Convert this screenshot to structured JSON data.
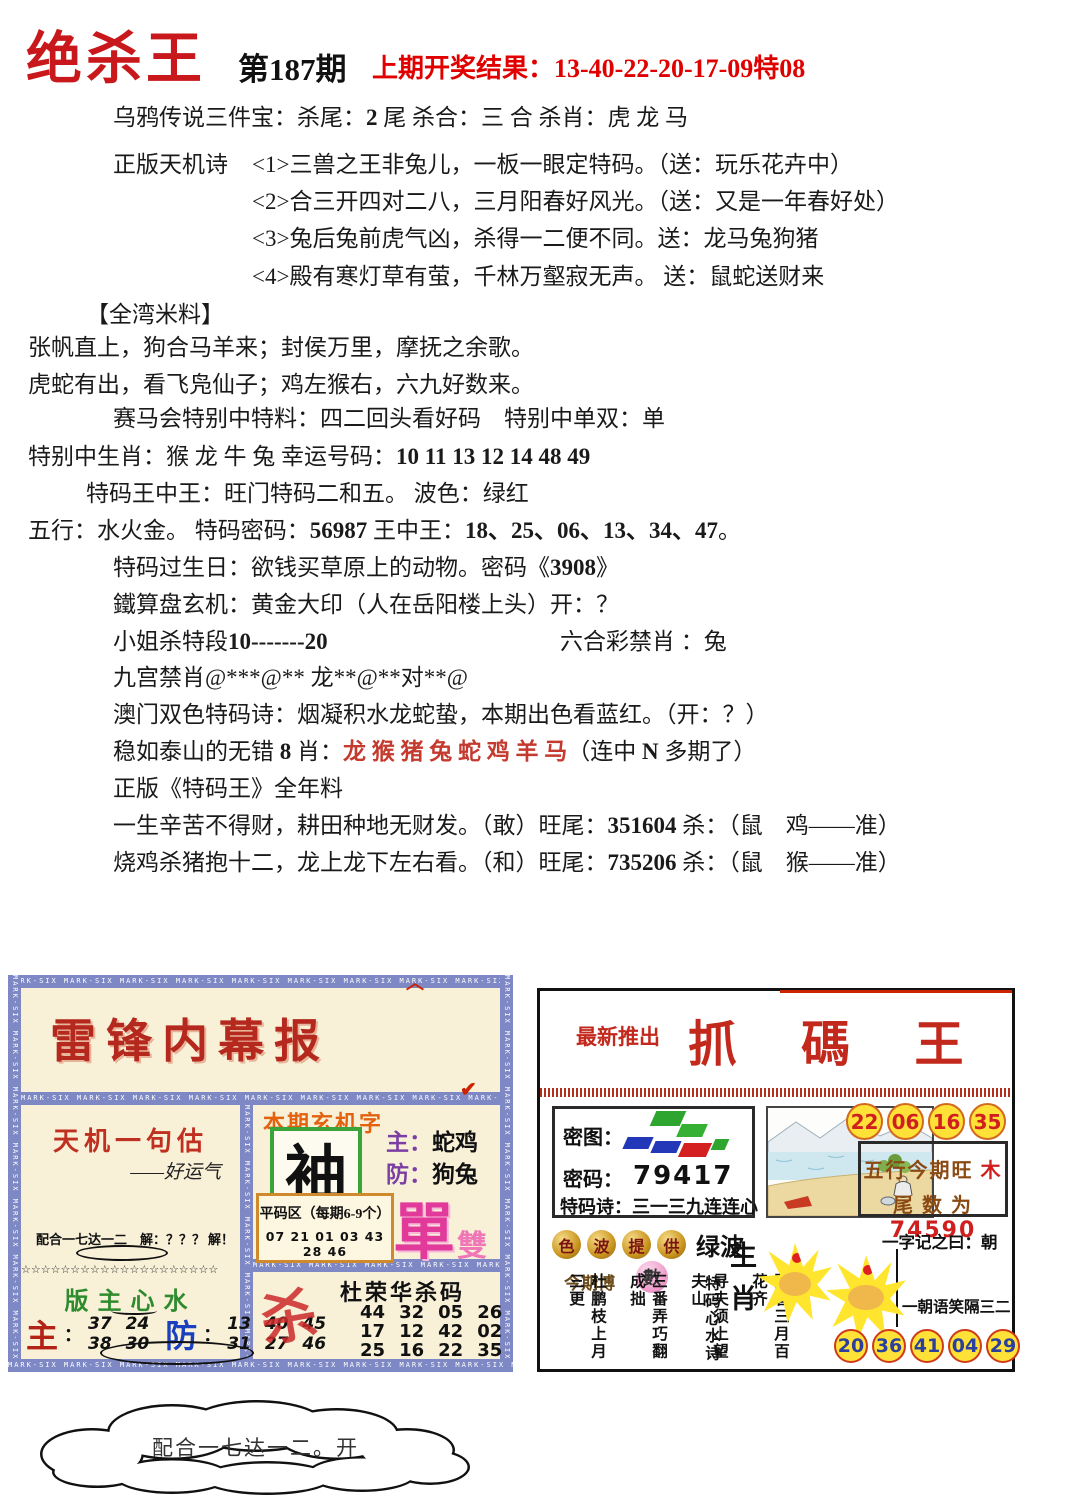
{
  "header": {
    "title": "绝杀王",
    "issue": "第187期",
    "result": "上期开奖结果：13-40-22-20-17-09特08"
  },
  "main": {
    "lines": [
      [
        {
          "t": "乌鸦传说三件宝：杀尾："
        },
        {
          "t": "2",
          "c": "b"
        },
        {
          "t": " 尾 杀合：三 合 杀肖：虎 龙 马"
        }
      ],
      [
        {
          "t": "正版天机诗"
        }
      ],
      [
        {
          "t": "<1>三兽之王非兔儿，一板一眼定特码。（送：玩乐花卉中）"
        }
      ],
      [
        {
          "t": "<2>合三开四对二八，三月阳春好风光。（送：又是一年春好处）"
        }
      ],
      [
        {
          "t": "<3>兔后兔前虎气凶，杀得一二便不同。送：龙马兔狗猪"
        }
      ],
      [
        {
          "t": "<4>殿有寒灯草有萤，千林万壑寂无声。 送：鼠蛇送财来"
        }
      ],
      [
        {
          "t": "【全湾米料】"
        }
      ],
      [
        {
          "t": "张帆直上，狗合马羊来；封侯万里，摩抚之余歌。"
        }
      ],
      [
        {
          "t": "虎蛇有出，看飞凫仙子；鸡左猴右，六九好数来。"
        }
      ],
      [
        {
          "t": "赛马会特别中特料：四二回头看好码　特别中单双：单"
        }
      ],
      [
        {
          "t": "特别中生肖：猴 龙 牛 兔 幸运号码："
        },
        {
          "t": "10 11 13 12 14 48 49",
          "c": "b"
        }
      ],
      [
        {
          "t": "特码王中王：旺门特码二和五。 波色：绿红"
        }
      ],
      [
        {
          "t": "五行：水火金。 特码密码："
        },
        {
          "t": "56987",
          "c": "b"
        },
        {
          "t": " 王中王："
        },
        {
          "t": "18、25、06、13、34、47",
          "c": "b"
        },
        {
          "t": "。"
        }
      ],
      [
        {
          "t": "特码过生日：欲钱买草原上的动物。密码《"
        },
        {
          "t": "3908",
          "c": "b"
        },
        {
          "t": "》"
        }
      ],
      [
        {
          "t": "鐵算盘玄机：黄金大印（人在岳阳楼上头）开：？"
        }
      ],
      [
        {
          "t": "小姐杀特段"
        },
        {
          "t": "10-------20",
          "c": "b"
        }
      ],
      [
        {
          "t": "六合彩禁肖 ：兔"
        }
      ],
      [
        {
          "t": "九宫禁肖@***@** 龙**@**对**@"
        }
      ],
      [
        {
          "t": "澳门双色特码诗：烟凝积水龙蛇蛰，本期出色看蓝红。（开：？）"
        }
      ],
      [
        {
          "t": "稳如泰山的无错 "
        },
        {
          "t": "8",
          "c": "b"
        },
        {
          "t": " 肖："
        },
        {
          "t": "龙 猴 猪 兔 蛇 鸡 羊 马",
          "c": "r"
        },
        {
          "t": "（连中 "
        },
        {
          "t": "N",
          "c": "b"
        },
        {
          "t": " 多期了）"
        }
      ],
      [
        {
          "t": "正版《特码王》全年料"
        }
      ],
      [
        {
          "t": "一生辛苦不得财，耕田种地无财发。（敢）旺尾："
        },
        {
          "t": "351604",
          "c": "b"
        },
        {
          "t": " 杀：（鼠　鸡——准）"
        }
      ],
      [
        {
          "t": "烧鸡杀猪抱十二，龙上龙下左右看。（和）旺尾："
        },
        {
          "t": "735206",
          "c": "b"
        },
        {
          "t": " 杀：（鼠　猴——准）"
        }
      ]
    ]
  },
  "left_panel": {
    "border_text": "MARK-SIX ",
    "title": "雷锋内幕报",
    "caret_icon": "︿",
    "check_icon": "✔",
    "stars_char": "☆",
    "box_tianji": {
      "title": "天机一句估",
      "signature": "——好运气",
      "footer_left": "配合一七达一二　解：？？？",
      "footer_right": "解！"
    },
    "box_banzhu": {
      "title": "版主心水",
      "zhu_label": "主",
      "fang_label": "防",
      "colon": "：",
      "zhu_rows": [
        "37 24",
        "38 30"
      ],
      "fang_rows": [
        "13 40 45",
        "31 27 46"
      ]
    },
    "box_xuanji": {
      "title": "本期玄机字",
      "char": "袖",
      "zhu_label": "主：",
      "zhu_value": "蛇鸡",
      "fang_label": "防：",
      "fang_value": "狗兔",
      "pingma_title": "平码区（每期6-9个）",
      "pingma_numbers": "07 21 01 03 43 28 46",
      "dan": "單",
      "shuang": "雙"
    },
    "box_sha": {
      "glyph": "杀",
      "title": "杜荣华杀码",
      "rows": [
        [
          "44",
          "32",
          "05",
          "26"
        ],
        [
          "17",
          "12",
          "42",
          "02"
        ],
        [
          "25",
          "16",
          "22",
          "35"
        ]
      ]
    }
  },
  "right_panel": {
    "promo": "最新推出",
    "title": "抓 碼 王",
    "mitu_label": "密图：",
    "mima_label": "密码：",
    "mima_value": "79417",
    "shici_label": "特码诗：",
    "shici_value": "三一三九连连心",
    "top_circles": [
      "22",
      "06",
      "16",
      "35"
    ],
    "wuxing_text": "五行今期旺 ",
    "wuxing_value": "木",
    "weishu_text": "尾 数 为 ",
    "weishu_value": "74590",
    "sebo": [
      "色",
      "波",
      "提",
      "供"
    ],
    "lvbo": "绿波",
    "jinqibo": "今期博",
    "shu": "數",
    "yizi": "一字记之曰：朝",
    "yichao": "一朝语笑隔三二",
    "shengxiao": "生肖",
    "poem_title": "特码心水诗",
    "poem": [
      "阳春三月百花齐",
      "寻夫须上望夫山",
      "三番弄巧翻成拙",
      "杜鹏枝上月三更"
    ],
    "bottom_circles": [
      "20",
      "36",
      "41",
      "04",
      "29"
    ]
  },
  "cloud": {
    "text": "配合一七达一二。开"
  }
}
